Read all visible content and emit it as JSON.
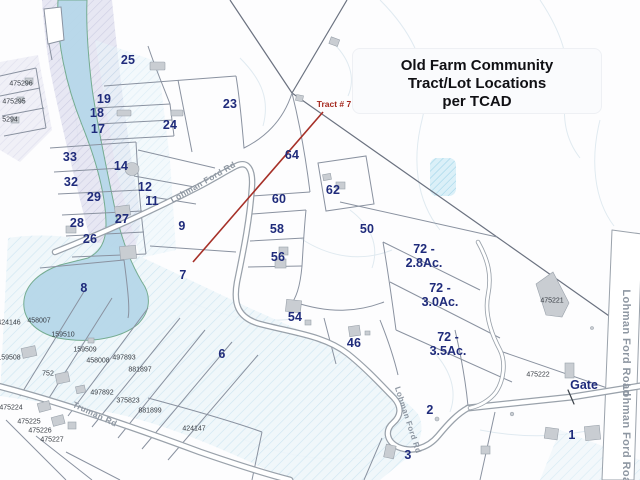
{
  "title": {
    "line1": "Old Farm Community",
    "line2": "Tract/Lot Locations",
    "line3": "per TCAD"
  },
  "annotation": {
    "label": "Tract # 7",
    "x": 334,
    "y": 104
  },
  "gate": {
    "label": "Gate",
    "x": 584,
    "y": 385
  },
  "lots": [
    {
      "label": "25",
      "x": 128,
      "y": 60
    },
    {
      "label": "23",
      "x": 230,
      "y": 104
    },
    {
      "label": "24",
      "x": 170,
      "y": 125
    },
    {
      "label": "19",
      "x": 104,
      "y": 99
    },
    {
      "label": "18",
      "x": 97,
      "y": 113
    },
    {
      "label": "17",
      "x": 98,
      "y": 129
    },
    {
      "label": "33",
      "x": 70,
      "y": 157
    },
    {
      "label": "32",
      "x": 71,
      "y": 182
    },
    {
      "label": "14",
      "x": 121,
      "y": 166
    },
    {
      "label": "12",
      "x": 145,
      "y": 187
    },
    {
      "label": "29",
      "x": 94,
      "y": 197
    },
    {
      "label": "11",
      "x": 152,
      "y": 201
    },
    {
      "label": "28",
      "x": 77,
      "y": 223
    },
    {
      "label": "27",
      "x": 122,
      "y": 219
    },
    {
      "label": "26",
      "x": 90,
      "y": 239
    },
    {
      "label": "9",
      "x": 182,
      "y": 226
    },
    {
      "label": "7",
      "x": 183,
      "y": 275
    },
    {
      "label": "8",
      "x": 84,
      "y": 288
    },
    {
      "label": "64",
      "x": 292,
      "y": 155
    },
    {
      "label": "62",
      "x": 333,
      "y": 190
    },
    {
      "label": "60",
      "x": 279,
      "y": 199
    },
    {
      "label": "58",
      "x": 277,
      "y": 229
    },
    {
      "label": "56",
      "x": 278,
      "y": 257
    },
    {
      "label": "50",
      "x": 367,
      "y": 229
    },
    {
      "label": "54",
      "x": 295,
      "y": 317
    },
    {
      "label": "46",
      "x": 354,
      "y": 343
    },
    {
      "label": "6",
      "x": 222,
      "y": 354
    },
    {
      "label": "2",
      "x": 430,
      "y": 410
    },
    {
      "label": "3",
      "x": 408,
      "y": 455
    },
    {
      "label": "1",
      "x": 572,
      "y": 435
    }
  ],
  "acreage": [
    {
      "label": "72 -\n2.8Ac.",
      "x": 424,
      "y": 256
    },
    {
      "label": "72 -\n3.0Ac.",
      "x": 440,
      "y": 295
    },
    {
      "label": "72 -\n3.5Ac.",
      "x": 448,
      "y": 344
    }
  ],
  "parcel_ids": [
    {
      "label": "475296",
      "x": 21,
      "y": 84
    },
    {
      "label": "475295",
      "x": 14,
      "y": 102
    },
    {
      "label": "5294",
      "x": 10,
      "y": 120
    },
    {
      "label": "424146",
      "x": 9,
      "y": 323
    },
    {
      "label": "458007",
      "x": 39,
      "y": 321
    },
    {
      "label": "159510",
      "x": 63,
      "y": 335
    },
    {
      "label": "159509",
      "x": 85,
      "y": 350
    },
    {
      "label": "159508",
      "x": 9,
      "y": 358
    },
    {
      "label": "458008",
      "x": 98,
      "y": 361
    },
    {
      "label": "497893",
      "x": 124,
      "y": 358
    },
    {
      "label": "881897",
      "x": 140,
      "y": 370
    },
    {
      "label": "497892",
      "x": 102,
      "y": 393
    },
    {
      "label": "375823",
      "x": 128,
      "y": 401
    },
    {
      "label": "881899",
      "x": 150,
      "y": 411
    },
    {
      "label": "424147",
      "x": 194,
      "y": 429
    },
    {
      "label": "752",
      "x": 48,
      "y": 374
    },
    {
      "label": "475224",
      "x": 11,
      "y": 408
    },
    {
      "label": "475225",
      "x": 29,
      "y": 422
    },
    {
      "label": "475226",
      "x": 40,
      "y": 431
    },
    {
      "label": "475227",
      "x": 52,
      "y": 440
    },
    {
      "label": "475221",
      "x": 552,
      "y": 301
    },
    {
      "label": "475222",
      "x": 538,
      "y": 375
    }
  ],
  "roads": [
    {
      "label": "Lohman Ford Rd",
      "x": 203,
      "y": 182,
      "rotate": -30
    },
    {
      "label": "Truman Rd",
      "x": 95,
      "y": 414,
      "rotate": 25
    },
    {
      "label": "Lohman Ford Rd",
      "x": 408,
      "y": 420,
      "rotate": 72,
      "size": 8
    },
    {
      "label": "Lohman Ford Road",
      "x": 626,
      "y": 343,
      "rotate": 90,
      "size": 11
    },
    {
      "label": "Lohman Ford Road",
      "x": 626,
      "y": 437,
      "rotate": 90,
      "size": 11
    }
  ],
  "colors": {
    "lot_number_navy": "#1f2b7b",
    "annotation_red": "#a5291f",
    "road_label_gray": "#8e97a2",
    "parcel_id_gray": "#363b42",
    "water_blue": "#b7d8ea",
    "floodplain_lavender": "#dfdfee",
    "building_gray": "#c9cdd2",
    "parcel_line_gray": "#8a92a0"
  }
}
